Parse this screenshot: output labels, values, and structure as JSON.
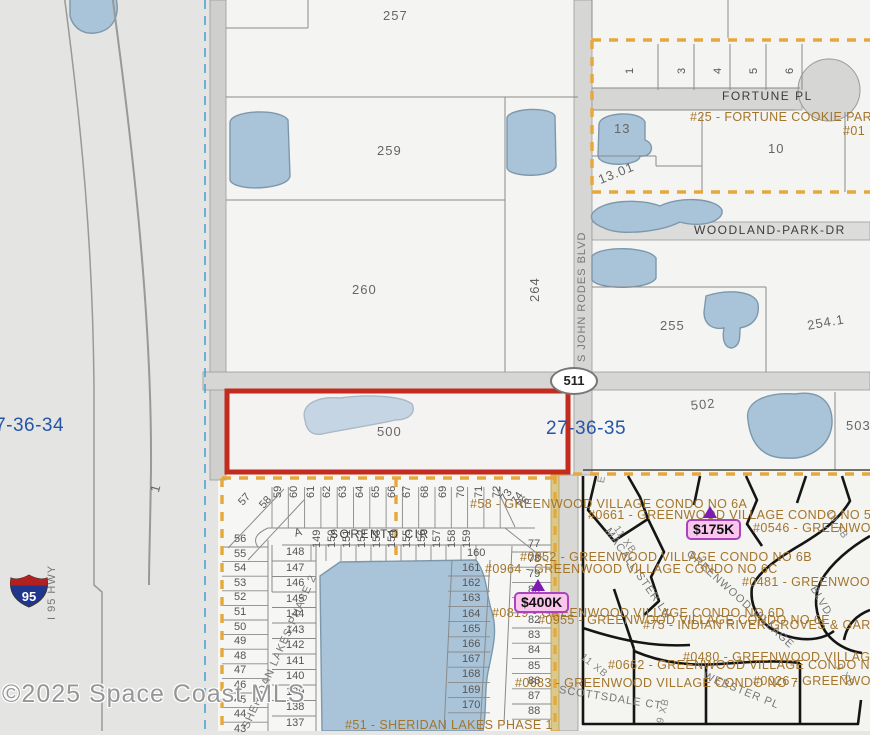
{
  "map": {
    "copyright": "©2025 Space Coast MLS",
    "shields": {
      "route511": "511",
      "interstate95": "95"
    },
    "tags": {
      "t175": {
        "label": "$175K"
      },
      "t400": {
        "label": "$400K"
      }
    },
    "labels": [
      {
        "name": "parcel-label-257",
        "text": "257",
        "x": 383,
        "y": 8,
        "cls": "pnum"
      },
      {
        "name": "parcel-label-259",
        "text": "259",
        "x": 377,
        "y": 143,
        "cls": "pnum"
      },
      {
        "name": "parcel-label-260",
        "text": "260",
        "x": 352,
        "y": 282,
        "cls": "pnum"
      },
      {
        "name": "parcel-label-264",
        "text": "264",
        "x": 527,
        "y": 302,
        "rot": -90,
        "cls": "pnum"
      },
      {
        "name": "parcel-label-255",
        "text": "255",
        "x": 660,
        "y": 318,
        "cls": "pnum"
      },
      {
        "name": "parcel-label-254-1",
        "text": "254.1",
        "x": 806,
        "y": 318,
        "rot": -10,
        "cls": "pnum"
      },
      {
        "name": "parcel-label-13",
        "text": "13",
        "x": 614,
        "y": 121,
        "cls": "pnum"
      },
      {
        "name": "parcel-label-13-01",
        "text": "13.01",
        "x": 596,
        "y": 173,
        "rot": -22,
        "cls": "pnum"
      },
      {
        "name": "parcel-label-10",
        "text": "10",
        "x": 768,
        "y": 141,
        "cls": "pnum"
      },
      {
        "name": "parcel-label-502",
        "text": "502",
        "x": 690,
        "y": 398,
        "rot": -6,
        "cls": "pnum"
      },
      {
        "name": "parcel-label-503",
        "text": "503",
        "x": 846,
        "y": 418,
        "cls": "pnum"
      },
      {
        "name": "parcel-label-500",
        "text": "500",
        "x": 377,
        "y": 424,
        "cls": "pnum"
      },
      {
        "name": "parcel-label-1",
        "text": "1",
        "x": 147,
        "y": 490,
        "rot": -75,
        "cls": "pnum"
      },
      {
        "name": "lot-label-fortune-1",
        "text": "1",
        "x": 624,
        "y": 74,
        "rot": -90,
        "cls": "lot"
      },
      {
        "name": "section-label-27-36-35",
        "text": "27-36-35",
        "x": 546,
        "y": 418,
        "cls": "sect"
      },
      {
        "name": "section-label-27-36-34",
        "text": "27-36-34",
        "x": -16,
        "y": 415,
        "cls": "sect"
      },
      {
        "name": "street-label-fortune-pl",
        "text": "FORTUNE PL",
        "x": 722,
        "y": 89,
        "cls": "road"
      },
      {
        "name": "street-label-woodland-park-dr",
        "text": "WOODLAND-PARK-DR",
        "x": 694,
        "y": 223,
        "cls": "road"
      },
      {
        "name": "street-label-sorento-cir",
        "text": "SORENTO CIR",
        "x": 330,
        "y": 527,
        "cls": "road"
      },
      {
        "name": "street-label-s-john-rodes-blvd",
        "text": "S JOHN RODES BLVD",
        "x": 576,
        "y": 362,
        "rot": -90,
        "cls": "roadv"
      },
      {
        "name": "street-label-i95-hwy",
        "text": "I 95 HWY",
        "x": 46,
        "y": 620,
        "rot": -90,
        "cls": "roadv"
      },
      {
        "name": "street-label-macallister-ln",
        "text": "MACALLISTER LN",
        "x": 612,
        "y": 526,
        "rot": 55,
        "cls": "roadv"
      },
      {
        "name": "street-label-greenwood-village",
        "text": "GREENWOOD VILLAGE",
        "x": 692,
        "y": 548,
        "rot": 42,
        "cls": "roadv"
      },
      {
        "name": "street-label-blvd",
        "text": "BLVD",
        "x": 818,
        "y": 584,
        "rot": 60,
        "cls": "roadv"
      },
      {
        "name": "street-label-scottsdale-ct",
        "text": "SCOTTSDALE CT",
        "x": 560,
        "y": 684,
        "rot": 9,
        "cls": "roadv"
      },
      {
        "name": "street-label-webster-pl",
        "text": "WEBSTER PL",
        "x": 706,
        "y": 670,
        "rot": 22,
        "cls": "roadv"
      },
      {
        "name": "street-label-sheridan-lakes-phase-2",
        "text": "SHERIDAN LAKES-PHASE 2",
        "x": 240,
        "y": 726,
        "rot": -66,
        "cls": "roadv"
      },
      {
        "name": "grid-label-11xb-a",
        "text": "11 XB",
        "x": 620,
        "y": 524,
        "rot": 55,
        "cls": "gridlab"
      },
      {
        "name": "grid-label-11xb-b",
        "text": "11 XB",
        "x": 585,
        "y": 652,
        "rot": 38,
        "cls": "gridlab"
      },
      {
        "name": "grid-label-10xb",
        "text": "10 XB",
        "x": 833,
        "y": 508,
        "rot": 58,
        "cls": "gridlab"
      },
      {
        "name": "grid-label-9xb-a",
        "text": "9 XB",
        "x": 655,
        "y": 722,
        "rot": -76,
        "cls": "gridlab"
      },
      {
        "name": "grid-label-9xb-b",
        "text": "9 XB",
        "x": 842,
        "y": 662,
        "rot": 55,
        "cls": "gridlab"
      },
      {
        "name": "grid-label-e",
        "text": "E",
        "x": 596,
        "y": 482,
        "rot": -80,
        "cls": "gridlab"
      },
      {
        "name": "lot-label-a",
        "text": "A",
        "x": 293,
        "y": 528,
        "rot": -15,
        "cls": "lot"
      },
      {
        "name": "lot-label-57",
        "text": "57",
        "x": 236,
        "y": 500,
        "rot": -48,
        "cls": "lot"
      },
      {
        "name": "lot-label-58",
        "text": "58",
        "x": 257,
        "y": 503,
        "rot": -48,
        "cls": "lot"
      },
      {
        "name": "lot-label-73",
        "text": "73",
        "x": 498,
        "y": 497,
        "rot": -55,
        "cls": "lot"
      },
      {
        "name": "lot-label-74",
        "text": "74",
        "x": 509,
        "y": 500,
        "rot": -55,
        "cls": "lot"
      },
      {
        "name": "lot-label-76",
        "text": "76",
        "x": 515,
        "y": 503,
        "rot": -45,
        "cls": "lot"
      },
      {
        "name": "lot-label-160",
        "text": "160",
        "x": 467,
        "y": 547,
        "cls": "lot"
      },
      {
        "name": "condo-label-fortune-cookie-park",
        "text": "#25 - FORTUNE COOKIE PARK",
        "x": 690,
        "y": 110,
        "cls": "condo"
      },
      {
        "name": "condo-label-01",
        "text": "#01",
        "x": 843,
        "y": 124,
        "cls": "condo"
      },
      {
        "name": "condo-label-6a",
        "text": "#58 - GREENWOOD VILLAGE CONDO NO 6A",
        "x": 470,
        "y": 497,
        "cls": "condo"
      },
      {
        "name": "condo-label-no5",
        "text": "#0661 - GREENWOOD VILLAGE CONDO NO 5",
        "x": 588,
        "y": 508,
        "cls": "condo"
      },
      {
        "name": "condo-label-0546",
        "text": "#0546 - GREENWOOD VI",
        "x": 753,
        "y": 521,
        "cls": "condo"
      },
      {
        "name": "condo-label-6b",
        "text": "#0852 - GREENWOOD VILLAGE CONDO NO 6B",
        "x": 520,
        "y": 550,
        "cls": "condo"
      },
      {
        "name": "condo-label-6c",
        "text": "#0964 - GREENWOOD VILLAGE CONDO NO 6C",
        "x": 485,
        "y": 562,
        "cls": "condo"
      },
      {
        "name": "condo-label-0481",
        "text": "#0481 - GREENWOOD V",
        "x": 742,
        "y": 575,
        "cls": "condo"
      },
      {
        "name": "condo-label-6d",
        "text": "#0819 - GREENWOOD VILLAGE CONDO NO 6D",
        "x": 492,
        "y": 606,
        "cls": "condo"
      },
      {
        "name": "condo-label-6e",
        "text": "#0955 - GREENWOOD VILLAGE CONDO NO 6E",
        "x": 538,
        "y": 613,
        "cls": "condo"
      },
      {
        "name": "condo-label-indian-river",
        "text": "#75 - INDIAN RIVER GROVES & GARDENS",
        "x": 643,
        "y": 618,
        "cls": "condo"
      },
      {
        "name": "condo-label-0480",
        "text": "#0480 - GREENWOOD VILLAGE CONDO",
        "x": 683,
        "y": 650,
        "cls": "condo"
      },
      {
        "name": "condo-label-no8",
        "text": "#0662 - GREENWOOD VILLAGE CONDO NO 8",
        "x": 608,
        "y": 658,
        "cls": "condo"
      },
      {
        "name": "condo-label-no7",
        "text": "#0683 - GREENWOOD VILLAGE CONDO NO 7",
        "x": 515,
        "y": 676,
        "cls": "condo"
      },
      {
        "name": "condo-label-0026",
        "text": "#0026 - GREENWOOD",
        "x": 753,
        "y": 674,
        "cls": "condo"
      },
      {
        "name": "condo-label-sheridan-phase-1",
        "text": "#51 - SHERIDAN LAKES PHASE 1",
        "x": 345,
        "y": 718,
        "cls": "condo"
      }
    ],
    "lot_rows": [
      {
        "name": "fortune-row",
        "y": 74,
        "rot": -90,
        "start_x": 676,
        "step": 36,
        "cls": "lot",
        "values": [
          "3",
          "4",
          "5",
          "6"
        ]
      },
      {
        "name": "sorento-top-row-west",
        "y": 498,
        "rot": -90,
        "start_x": 272,
        "step": 16.3,
        "cls": "lot",
        "values": [
          "59",
          "60",
          "61",
          "62",
          "63",
          "64",
          "65",
          "66"
        ]
      },
      {
        "name": "sorento-top-row-east",
        "y": 498,
        "rot": -90,
        "start_x": 401,
        "step": 18,
        "cls": "lot",
        "values": [
          "67",
          "68",
          "69",
          "70",
          "71",
          "72"
        ]
      },
      {
        "name": "sorento-row2",
        "y": 548,
        "rot": -90,
        "start_x": 311,
        "step": 15,
        "cls": "lot",
        "values": [
          "149",
          "150",
          "151",
          "152",
          "153",
          "154",
          "155",
          "156",
          "157",
          "158",
          "159"
        ]
      }
    ],
    "lot_columns": [
      {
        "name": "sheridan-west-col",
        "x": 234,
        "start_y": 533,
        "step": 14.6,
        "cls": "lot",
        "values": [
          "56",
          "55",
          "54",
          "53",
          "52",
          "51",
          "50",
          "49",
          "48",
          "47",
          "46",
          "45",
          "44",
          "43"
        ]
      },
      {
        "name": "sheridan-col2",
        "x": 286,
        "start_y": 546,
        "step": 15.5,
        "cls": "lot",
        "values": [
          "148",
          "147",
          "146",
          "145",
          "144",
          "143",
          "142",
          "141",
          "140",
          "139",
          "138",
          "137"
        ]
      },
      {
        "name": "sheridan-mid-col",
        "x": 462,
        "start_y": 562,
        "step": 15.2,
        "cls": "lot",
        "values": [
          "161",
          "162",
          "163",
          "164",
          "165",
          "166",
          "167",
          "168",
          "169",
          "170"
        ]
      },
      {
        "name": "sheridan-east-col",
        "x": 528,
        "start_y": 538,
        "step": 15.2,
        "cls": "lot",
        "values": [
          "77",
          "78",
          "79",
          "80",
          "",
          "82",
          "83",
          "84",
          "85",
          "86",
          "87",
          "88"
        ]
      }
    ]
  }
}
